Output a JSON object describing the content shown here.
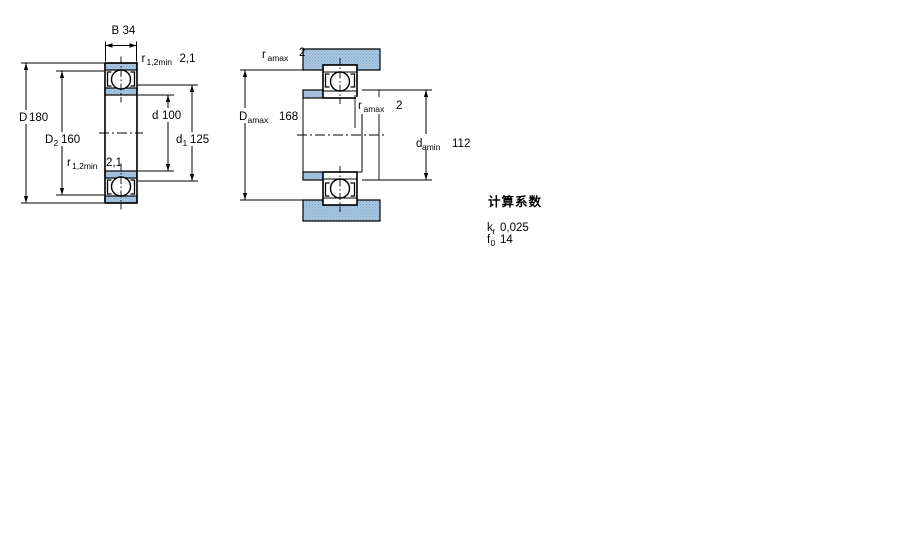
{
  "drawing": {
    "left_view": {
      "b": {
        "symbol": "B",
        "value": "34"
      },
      "r_top": {
        "symbol": "r",
        "sub": "1,2min",
        "value": "2,1"
      },
      "D": {
        "symbol": "D",
        "value": "180"
      },
      "D2": {
        "symbol": "D",
        "sub": "2",
        "value": "160"
      },
      "d": {
        "symbol": "d",
        "value": "100"
      },
      "d1": {
        "symbol": "d",
        "sub": "1",
        "value": "125"
      },
      "r_bottom": {
        "symbol": "r",
        "sub": "1,2min",
        "value": "2,1"
      }
    },
    "right_view": {
      "ra_top": {
        "symbol": "r",
        "sub": "amax",
        "value": "2"
      },
      "Damax": {
        "symbol": "D",
        "sub": "amax",
        "value": "168"
      },
      "ra_mid": {
        "symbol": "r",
        "sub": "amax",
        "value": "2"
      },
      "damin": {
        "symbol": "d",
        "sub": "amin",
        "value": "112"
      }
    },
    "calculation_factors": {
      "heading": "计算系数",
      "rows": [
        {
          "symbol": "k",
          "sub": "r",
          "value": "0,025"
        },
        {
          "symbol": "f",
          "sub": "0",
          "value": "14"
        }
      ]
    },
    "colors": {
      "section_fill": "#abc8e2",
      "hatch_dot": "#7fa5c9",
      "line": "#000000",
      "background": "#ffffff"
    }
  }
}
